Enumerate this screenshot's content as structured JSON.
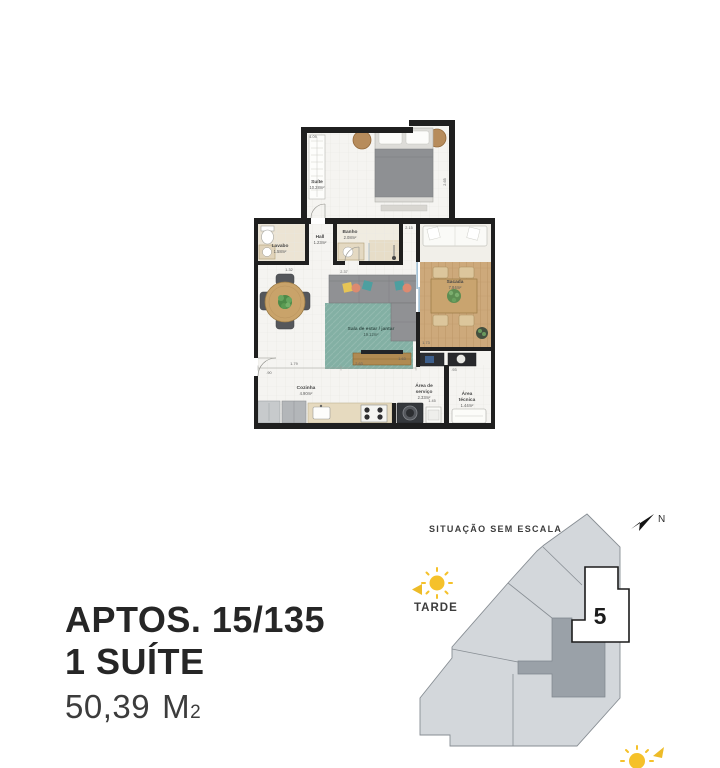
{
  "plan": {
    "rooms": {
      "suite": {
        "name": "Suíte",
        "area": "10.28m²"
      },
      "lavabo": {
        "name": "Lavabo",
        "area": "1.58m²"
      },
      "hall": {
        "name": "Hall",
        "area": "1.23m²"
      },
      "banho": {
        "name": "Banho",
        "area": "2.08m²"
      },
      "sacada": {
        "name": "Sacada",
        "area": "7.84m²"
      },
      "sala": {
        "name": "Sala de estar / jantar",
        "area": "19.12m²"
      },
      "cozinha": {
        "name": "Cozinha",
        "area": "4.90m²"
      },
      "servico": {
        "name1": "Área de",
        "name2": "serviço",
        "area": "2.33m²"
      },
      "tecnica": {
        "name1": "Área",
        "name2": "técnica",
        "area": "1.44m²"
      }
    },
    "dims": {
      "suite_top": "4.09",
      "suite_right": "2.65",
      "banho_top": "2.15",
      "sofa_top": "2.37",
      "table_top": "1.32",
      "kitchen_left": "1.79",
      "kitchen_mid": "2.63",
      "servico_top": "1.45",
      "console_right": "1.73",
      "console_bottom": "1.63",
      "left_side": ".90",
      "right_side": ".93"
    }
  },
  "info": {
    "line1": "APTOS. 15/135",
    "line2": "1 SUÍTE",
    "area_value": "50,39",
    "area_unit": "M",
    "area_sub": "2"
  },
  "situation": {
    "title": "SITUAÇÃO SEM ESCALA",
    "north_label": "N",
    "sun_label": "TARDE",
    "unit_number": "5"
  },
  "colors": {
    "wall": "#1f1f1f",
    "rug_teal": "#83b0a4",
    "wood": "#c9a46f",
    "sun_yellow": "#f5c12a",
    "building_gray": "#d3d7db",
    "highlight_unit_gray": "#9aa1a8",
    "selected_unit_white": "#ffffff"
  }
}
